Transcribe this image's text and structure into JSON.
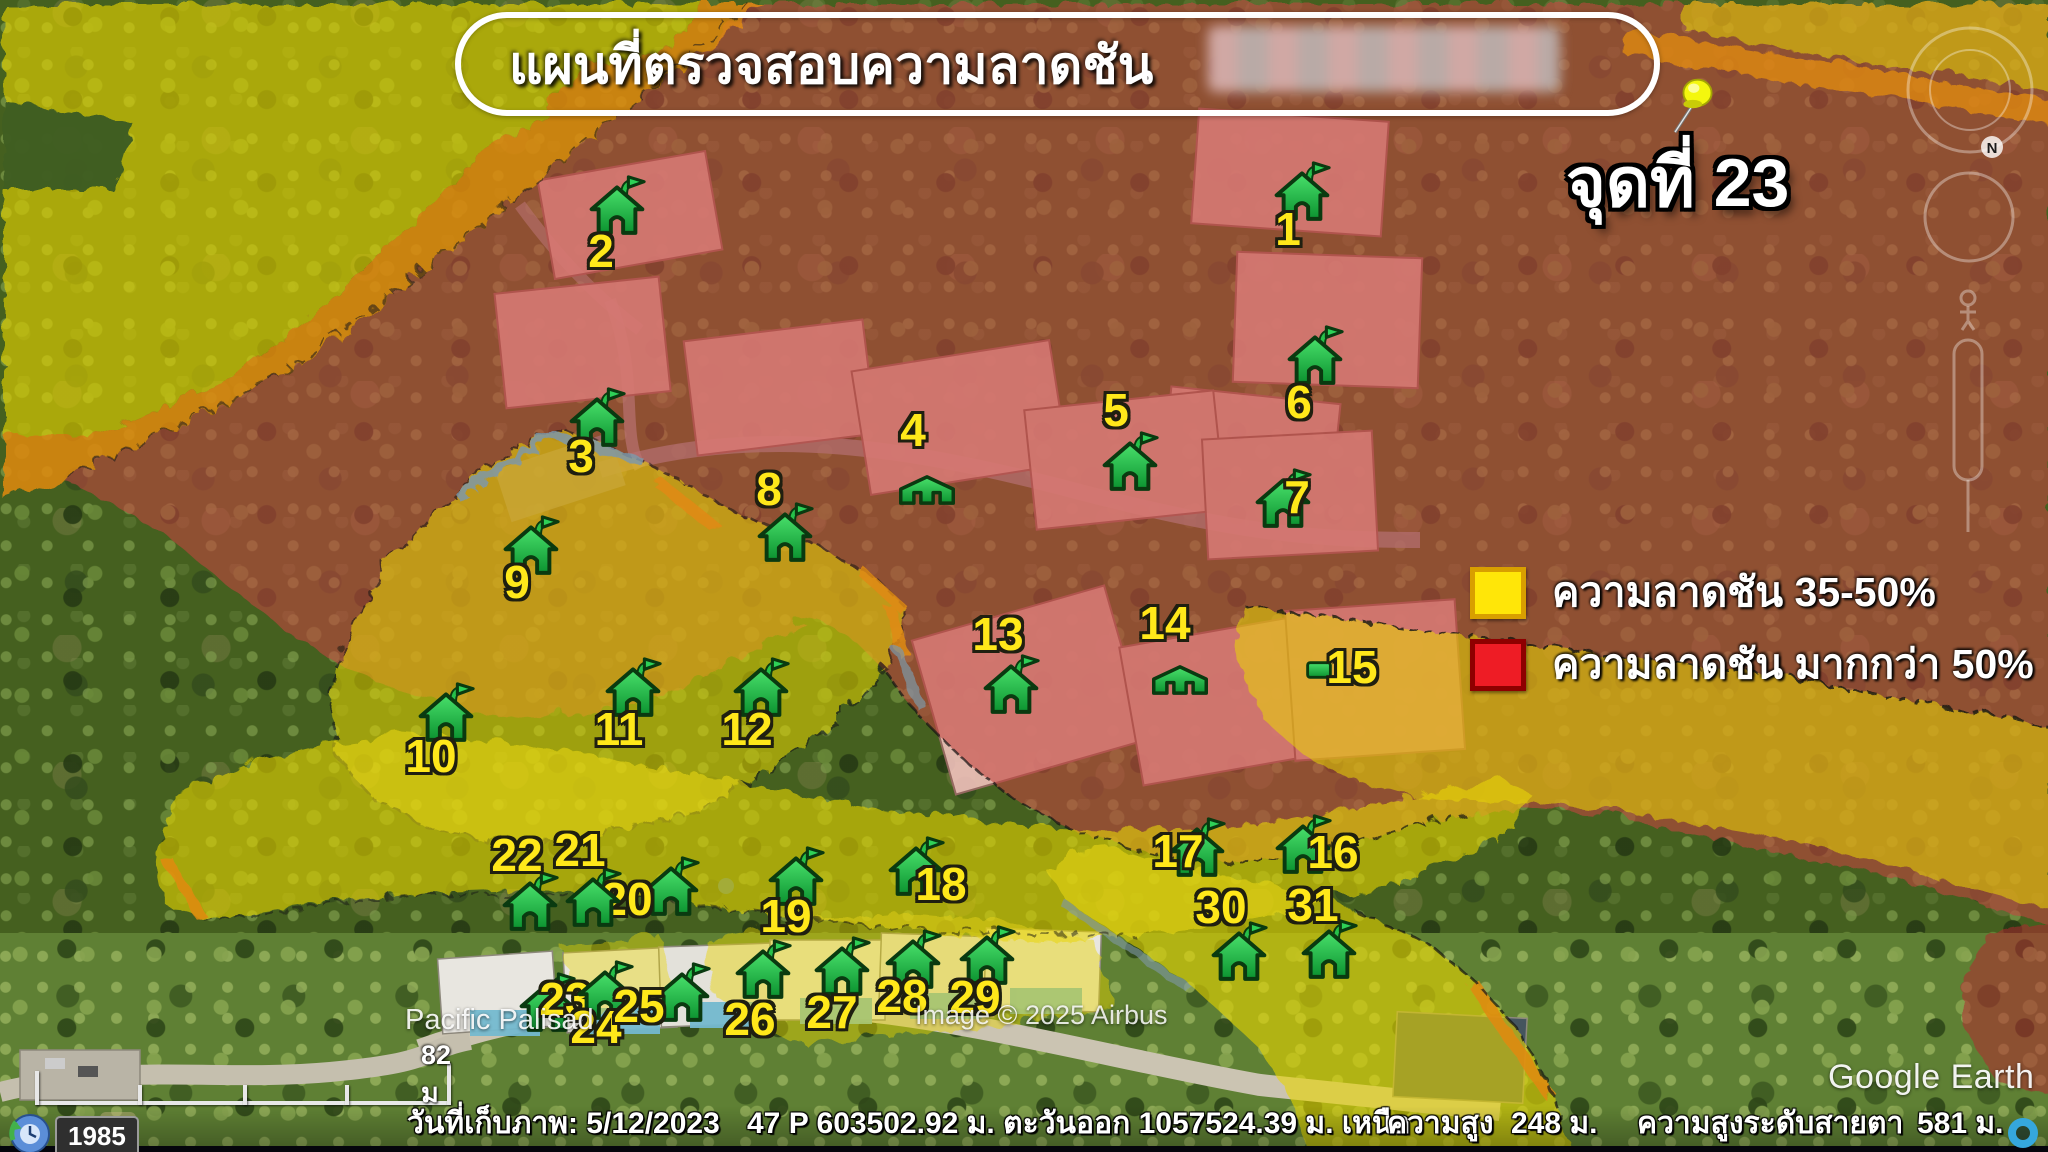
{
  "title": {
    "text": "แผนที่ตรวจสอบความลาดชัน"
  },
  "point_label": "จุดที่ 23",
  "legend": {
    "items": [
      {
        "label": "ความลาดชัน 35-50%",
        "color": "#ffe608",
        "border": "#d89f00"
      },
      {
        "label": "ความลาดชัน มากกว่า 50%",
        "color": "#ee1c25",
        "border": "#8e0000"
      }
    ]
  },
  "status_bar": {
    "date": "วันที่เก็บภาพ: 5/12/2023",
    "utm": "47 P 603502.92 ม. ตะวันออก 1057524.39 ม. เหนือ",
    "altitude_label": "ความสูง",
    "altitude_value": "248 ม.",
    "eye_altitude_label": "ความสูงระดับสายตา",
    "eye_altitude_value": "581 ม."
  },
  "time_slider": {
    "year": "1985"
  },
  "scale_bar": {
    "label": "82 ม"
  },
  "place_label": "Pacific Palisad",
  "credit": "Image © 2025 Airbus",
  "logo": "Google Earth",
  "compass": {
    "north": "N"
  },
  "markers": [
    {
      "n": "1",
      "type": "flag",
      "ix": 1302,
      "iy": 190,
      "lx": 1288,
      "ly": 229
    },
    {
      "n": "2",
      "type": "flag",
      "ix": 617,
      "iy": 204,
      "lx": 601,
      "ly": 251
    },
    {
      "n": "3",
      "type": "flag",
      "ix": 597,
      "iy": 416,
      "lx": 581,
      "ly": 456
    },
    {
      "n": "4",
      "type": "squat",
      "ix": 927,
      "iy": 490,
      "lx": 913,
      "ly": 430
    },
    {
      "n": "5",
      "type": "flag",
      "ix": 1130,
      "iy": 460,
      "lx": 1116,
      "ly": 410
    },
    {
      "n": "6",
      "type": "flag",
      "ix": 1315,
      "iy": 354,
      "lx": 1299,
      "ly": 402
    },
    {
      "n": "7",
      "type": "flag",
      "ix": 1283,
      "iy": 497,
      "lx": 1297,
      "ly": 497
    },
    {
      "n": "8",
      "type": "flag",
      "ix": 785,
      "iy": 531,
      "lx": 769,
      "ly": 489
    },
    {
      "n": "9",
      "type": "flag",
      "ix": 531,
      "iy": 544,
      "lx": 517,
      "ly": 582
    },
    {
      "n": "10",
      "type": "flag",
      "ix": 446,
      "iy": 711,
      "lx": 431,
      "ly": 756
    },
    {
      "n": "11",
      "type": "flag",
      "ix": 633,
      "iy": 686,
      "lx": 619,
      "ly": 729
    },
    {
      "n": "12",
      "type": "flag",
      "ix": 761,
      "iy": 686,
      "lx": 747,
      "ly": 729
    },
    {
      "n": "13",
      "type": "flag",
      "ix": 1011,
      "iy": 683,
      "lx": 998,
      "ly": 634
    },
    {
      "n": "14",
      "type": "squat",
      "ix": 1180,
      "iy": 680,
      "lx": 1165,
      "ly": 623
    },
    {
      "n": "15",
      "type": "small",
      "ix": 1319,
      "iy": 670,
      "lx": 1352,
      "ly": 667
    },
    {
      "n": "16",
      "type": "flag",
      "ix": 1303,
      "iy": 843,
      "lx": 1333,
      "ly": 852
    },
    {
      "n": "17",
      "type": "flag",
      "ix": 1197,
      "iy": 846,
      "lx": 1178,
      "ly": 851
    },
    {
      "n": "18",
      "type": "flag",
      "ix": 916,
      "iy": 865,
      "lx": 941,
      "ly": 884
    },
    {
      "n": "19",
      "type": "flag",
      "ix": 796,
      "iy": 875,
      "lx": 786,
      "ly": 916
    },
    {
      "n": "20",
      "type": "flag",
      "ix": 671,
      "iy": 885,
      "lx": 627,
      "ly": 899
    },
    {
      "n": "21",
      "type": "flag",
      "ix": 593,
      "iy": 896,
      "lx": 580,
      "ly": 850
    },
    {
      "n": "22",
      "type": "flag",
      "ix": 530,
      "iy": 900,
      "lx": 517,
      "ly": 855
    },
    {
      "n": "23",
      "type": "flag",
      "ix": 547,
      "iy": 1001,
      "lx": 565,
      "ly": 999
    },
    {
      "n": "24",
      "type": "flag",
      "ix": 605,
      "iy": 989,
      "lx": 596,
      "ly": 1027
    },
    {
      "n": "25",
      "type": "flag",
      "ix": 682,
      "iy": 991,
      "lx": 639,
      "ly": 1006
    },
    {
      "n": "26",
      "type": "flag",
      "ix": 763,
      "iy": 968,
      "lx": 750,
      "ly": 1019
    },
    {
      "n": "27",
      "type": "flag",
      "ix": 842,
      "iy": 965,
      "lx": 832,
      "ly": 1012
    },
    {
      "n": "28",
      "type": "flag",
      "ix": 913,
      "iy": 958,
      "lx": 902,
      "ly": 996
    },
    {
      "n": "29",
      "type": "flag",
      "ix": 987,
      "iy": 954,
      "lx": 975,
      "ly": 997
    },
    {
      "n": "30",
      "type": "flag",
      "ix": 1239,
      "iy": 950,
      "lx": 1221,
      "ly": 907
    },
    {
      "n": "31",
      "type": "flag",
      "ix": 1329,
      "iy": 948,
      "lx": 1313,
      "ly": 905
    }
  ]
}
